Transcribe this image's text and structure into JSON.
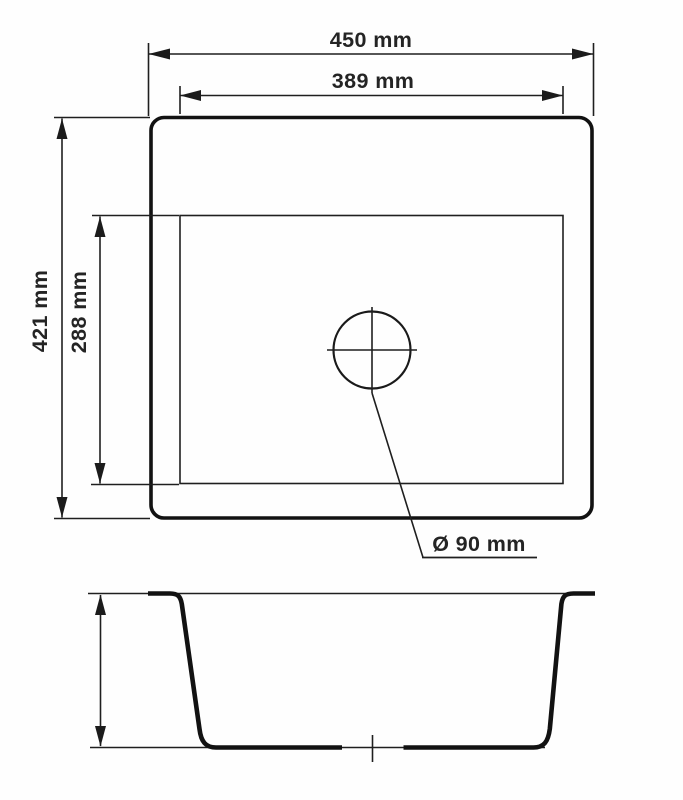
{
  "drawing": {
    "kind": "technical-dimension-drawing",
    "subject": "square kitchen sink, top view and section view",
    "background_color": "#fefefe",
    "line_color": "#1b1b1b",
    "text_color": "#242424",
    "labels": {
      "outer_width": "450 mm",
      "inner_width": "389 mm",
      "outer_depth": "421 mm",
      "inner_depth": "288 mm",
      "drain_diameter": "Ø 90 mm"
    },
    "dimensions_mm": {
      "outer_width": 450,
      "inner_width": 389,
      "outer_depth": 421,
      "inner_depth": 288,
      "drain_diameter": 90
    }
  }
}
